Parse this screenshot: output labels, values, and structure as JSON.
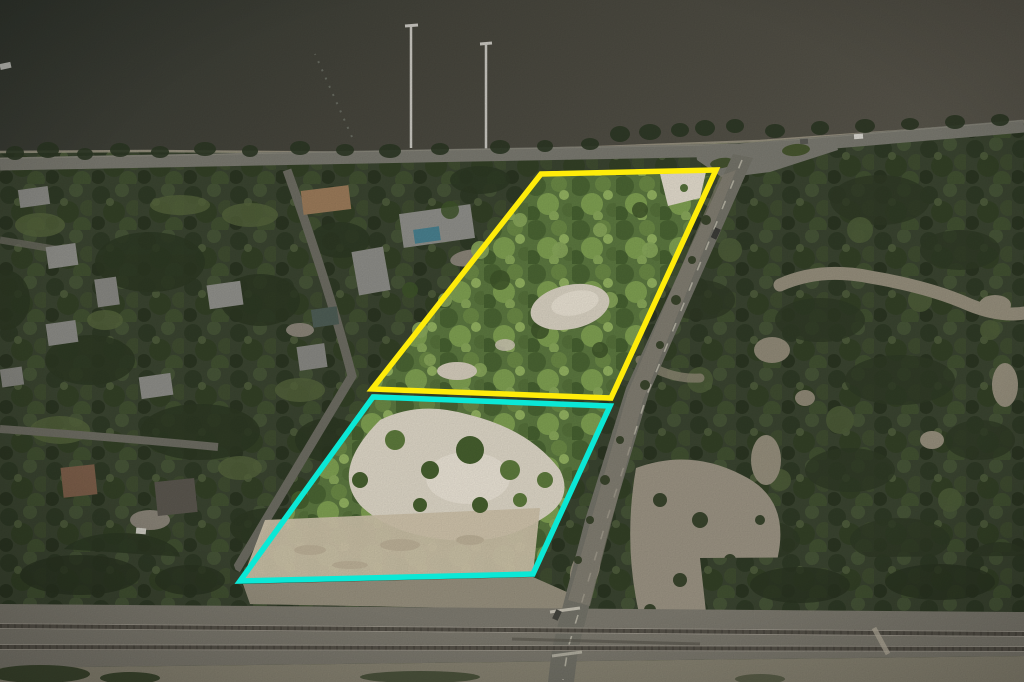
{
  "scene": {
    "description": "Aerial drone photo of two adjacent highlighted vacant land parcels located between a riverfront road and a railroad corridor, with a residential neighborhood to the west and coastal scrub preserve to the east",
    "outlines": {
      "north_parcel": "#FFEC0A",
      "south_parcel": "#0BE8D6"
    },
    "counts": {
      "piers": 2,
      "railroad_tracks": 2,
      "highlighted_parcels": 2
    },
    "palette": {
      "water_dark": "#31362E",
      "water_mid": "#46453C",
      "water_light": "#57544A",
      "shore_sand": "#ACA492",
      "canopy_dark": "#3A4430",
      "canopy_bright": "#5C7840",
      "sand_bright": "#DED7C7",
      "sand_core": "#EAE3D5",
      "sand_open": "#CEC2AA",
      "sand_muted": "#98917F",
      "road_asphalt": "#747369",
      "road_line": "#C9C5B5",
      "rail_ballast": "#7E7B70",
      "rail_south_gravel": "#8A8574",
      "rail_steel": "#57534A",
      "roof_gray": "#8E8E89",
      "roof_tan": "#9B7B5A",
      "roof_brown": "#7D5F4A",
      "roof_dark": "#5A564E",
      "pool_blue": "#49808F",
      "pier": "#C9C7C0"
    }
  }
}
